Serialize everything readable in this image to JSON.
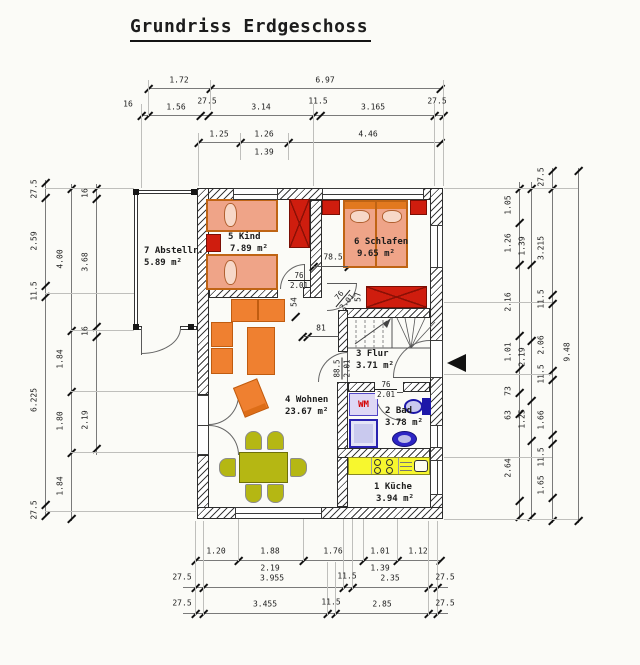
{
  "title": "Grundriss Erdgeschoss",
  "rooms": {
    "abstell": {
      "name": "7 Abstellr.",
      "area": "5.89 m²"
    },
    "kind": {
      "name": "5 Kind",
      "area": "7.89 m²"
    },
    "schlafen": {
      "name": "6 Schlafen",
      "area": "9.65 m²"
    },
    "wohnen": {
      "name": "4 Wohnen",
      "area": "23.67 m²"
    },
    "flur": {
      "name": "3 Flur",
      "area": "3.71 m²"
    },
    "bad": {
      "name": "2 Bad",
      "area": "3.78 m²"
    },
    "kueche": {
      "name": "1 Küche",
      "area": "3.94 m²"
    }
  },
  "appliances": {
    "washing_machine_label": "WM"
  },
  "dims": {
    "top": {
      "r1": [
        "1.72",
        "6.97"
      ],
      "r2": [
        "1.56",
        "3.14",
        "3.165"
      ],
      "r2s": [
        "16",
        "27.5",
        "11.5",
        "27.5"
      ],
      "r3": [
        "1.25",
        "1.26",
        "4.46"
      ],
      "r4": "1.39"
    },
    "bottom": {
      "r1": [
        "1.20",
        "1.88",
        "1.76",
        "1.01",
        "1.12"
      ],
      "r1b": [
        "2.19",
        "1.39"
      ],
      "r2": [
        "3.955",
        "2.35"
      ],
      "r2s": [
        "27.5",
        "11.5",
        "27.5"
      ],
      "r3": [
        "3.455",
        "2.85"
      ],
      "r3s": [
        "27.5",
        "11.5",
        "27.5"
      ]
    },
    "left": {
      "c1": [
        "27.5",
        "2.59",
        "11.5",
        "6.225",
        "27.5"
      ],
      "c2": [
        "4.00",
        "1.84",
        "1.80",
        "1.84"
      ],
      "c3": [
        "16",
        "3.68",
        "16",
        "2.19"
      ]
    },
    "right": {
      "c1": [
        "1.05",
        "1.26",
        "2.16",
        "1.01",
        "73",
        "63",
        "2.64"
      ],
      "c2": [
        "1.39",
        "2.19",
        "1.25"
      ],
      "c3": [
        "27.5",
        "3.215",
        "11.5",
        "2.06",
        "11.5",
        "1.66",
        "11.5",
        "1.65"
      ],
      "c4": "9.48"
    },
    "plan": {
      "niche": "78.5",
      "d54": "54",
      "d57": "57",
      "d81": "81",
      "door_kind": {
        "w": "76",
        "h": "2.01"
      },
      "door_schlafen": {
        "w": "76",
        "h": "2.01"
      },
      "door_flur": {
        "w": "88.5",
        "h": "2.01"
      },
      "door_bad": {
        "w": "76",
        "h": "2.01"
      }
    }
  },
  "colors": {
    "furniture_orange": "#ef8030",
    "mattress_salmon": "#efa488",
    "furniture_red": "#cf1d0e",
    "dining_olive": "#b5b713",
    "kitchen_yellow": "#f7f72e",
    "bath_blue": "#2a22b0",
    "wall_line": "#2c2c2c"
  }
}
